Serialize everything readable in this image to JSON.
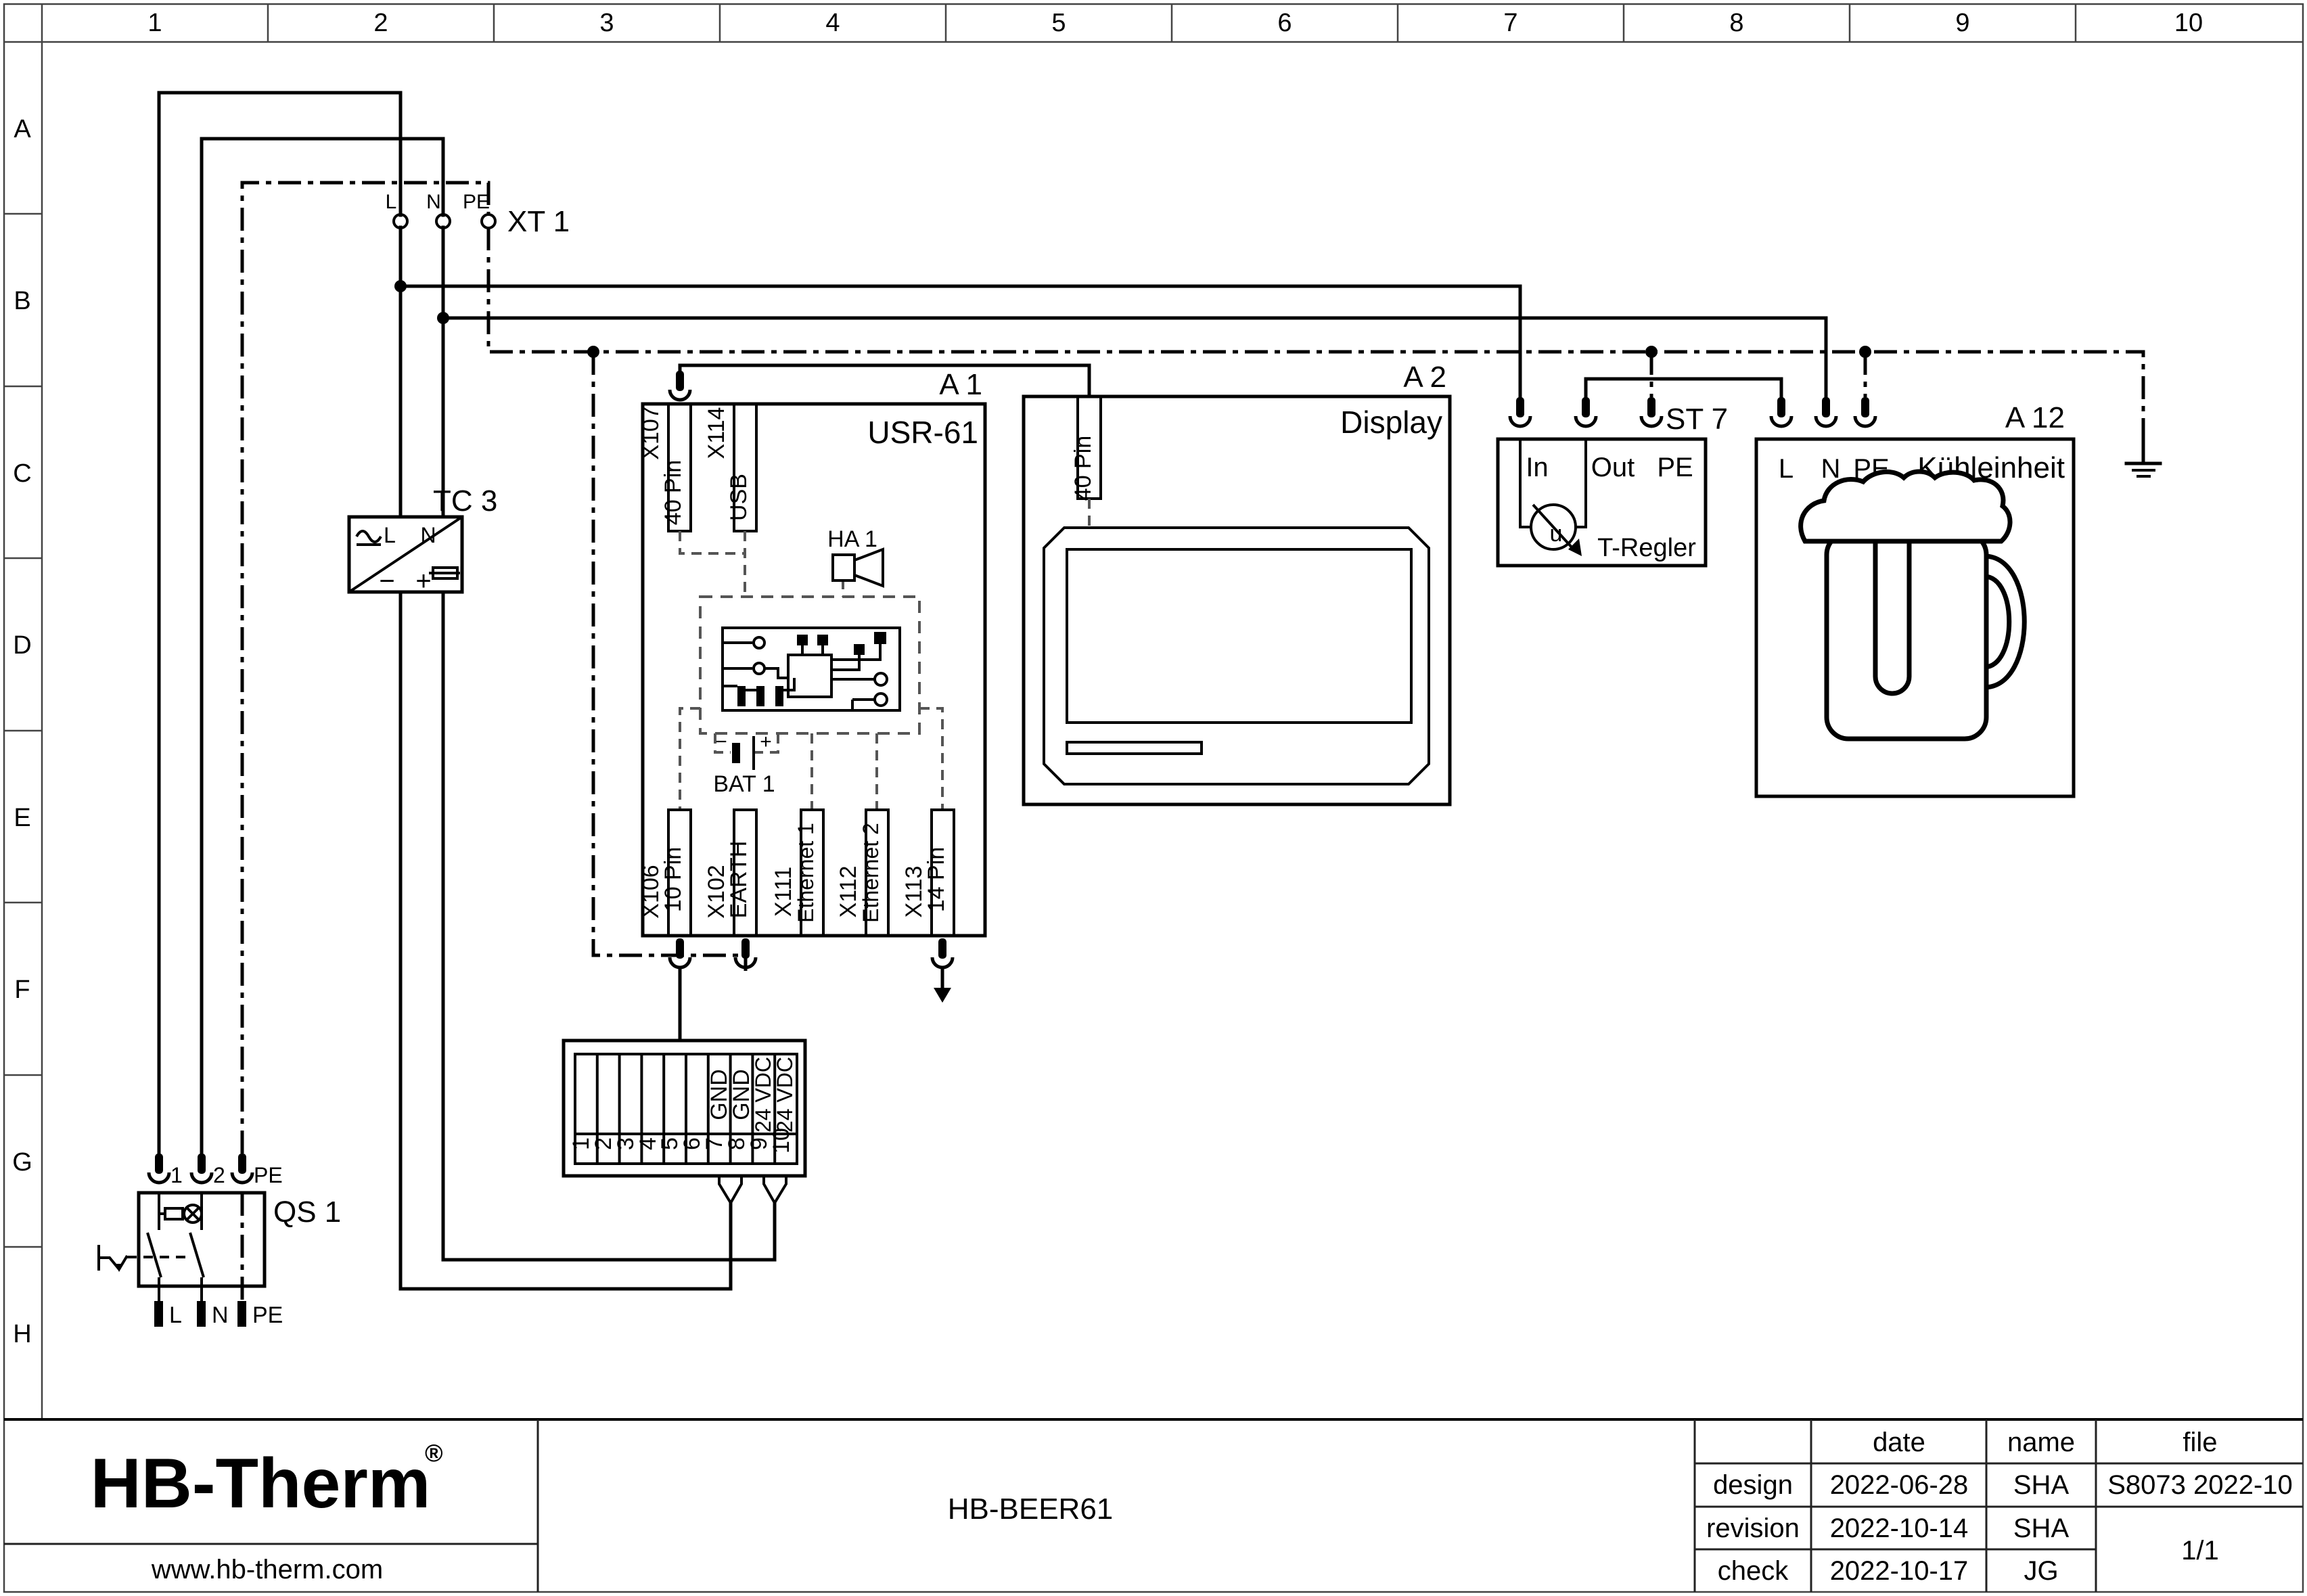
{
  "frame": {
    "columns": [
      "1",
      "2",
      "3",
      "4",
      "5",
      "6",
      "7",
      "8",
      "9",
      "10"
    ],
    "rows": [
      "A",
      "B",
      "C",
      "D",
      "E",
      "F",
      "G",
      "H"
    ]
  },
  "xt1": {
    "ref": "XT 1",
    "l": "L",
    "n": "N",
    "pe": "PE"
  },
  "tc3": {
    "ref": "TC 3",
    "l": "L",
    "n": "N",
    "minus": "−",
    "plus": "+"
  },
  "qs1": {
    "ref": "QS 1",
    "t1": "1",
    "t2": "2",
    "tpe": "PE",
    "bl": "L",
    "bn": "N",
    "bpe": "PE"
  },
  "a1": {
    "ref": "A 1",
    "name": "USR-61",
    "x107": {
      "id": "X107",
      "type": "40 Pin"
    },
    "x114": {
      "id": "X114",
      "type": "USB"
    },
    "x106": {
      "id": "X106",
      "type": "10 Pin"
    },
    "x102": {
      "id": "X102",
      "type": "EARTH"
    },
    "x111": {
      "id": "X111",
      "type": "Ethernet 1"
    },
    "x112": {
      "id": "X112",
      "type": "Ethernet 2"
    },
    "x113": {
      "id": "X113",
      "type": "14 Pin"
    },
    "ha1": "HA 1",
    "bat1": {
      "ref": "BAT 1",
      "minus": "−",
      "plus": "+"
    }
  },
  "a2": {
    "ref": "A 2",
    "name": "Display",
    "conn": "40 Pin"
  },
  "st7": {
    "ref": "ST 7",
    "in": "In",
    "out": "Out",
    "pe": "PE",
    "desc": "T-Regler",
    "dial": "u"
  },
  "a12": {
    "ref": "A 12",
    "name": "Kühleinheit",
    "l": "L",
    "n": "N",
    "pe": "PE"
  },
  "terminal_block": {
    "numbers": [
      "1",
      "2",
      "3",
      "4",
      "5",
      "6",
      "7",
      "8",
      "9",
      "10"
    ],
    "l7": "GND",
    "l8": "GND",
    "l9": "24 VDC",
    "l10": "24 VDC"
  },
  "title_block": {
    "logo_text": "HB-Therm",
    "logo_reg": "®",
    "logo_color": "#1c2b5e",
    "website": "www.hb-therm.com",
    "drawing_title": "HB-BEER61",
    "table": {
      "col_date": "date",
      "col_name": "name",
      "col_file": "file",
      "r1_label": "design",
      "r1_date": "2022-06-28",
      "r1_name": "SHA",
      "r2_label": "revision",
      "r2_date": "2022-10-14",
      "r2_name": "SHA",
      "r3_label": "check",
      "r3_date": "2022-10-17",
      "r3_name": "JG",
      "file_value": "S8073 2022-10",
      "page": "1/1"
    }
  }
}
